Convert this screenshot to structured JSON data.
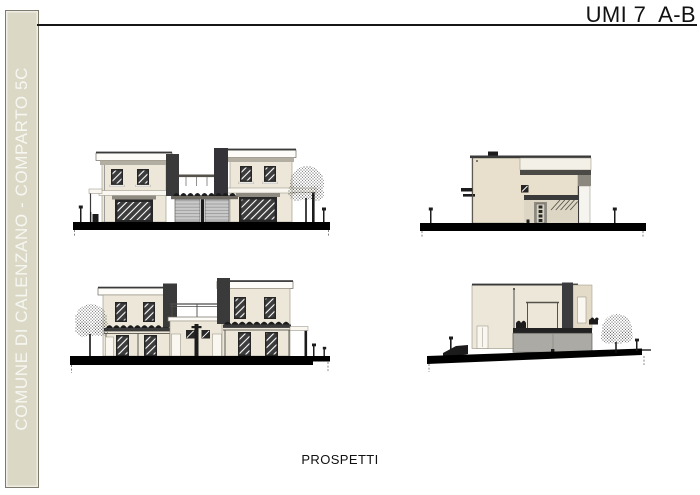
{
  "header": {
    "title": "UMI 7  A-B"
  },
  "sidebar": {
    "label": "COMUNE DI CALENZANO - COMPARTO 5C"
  },
  "footer": {
    "caption": "PROSPETTI"
  },
  "drawings": [
    {
      "id": "elevation-front",
      "position": "top-left"
    },
    {
      "id": "elevation-side-a",
      "position": "top-right"
    },
    {
      "id": "elevation-rear",
      "position": "bottom-left"
    },
    {
      "id": "elevation-side-b",
      "position": "bottom-right"
    }
  ],
  "colors": {
    "sidebar_fill": "#DBD8C6",
    "wall_cream": "#ECE7D9",
    "wall_tan": "#E8E0CD",
    "dark_accent": "#3A3A3A",
    "roof_band": "#B2AEA1",
    "door_gray": "#C9C9C9",
    "lower_volume_gray": "#ABAAA4",
    "ground": "#000000",
    "text": "#111111"
  }
}
